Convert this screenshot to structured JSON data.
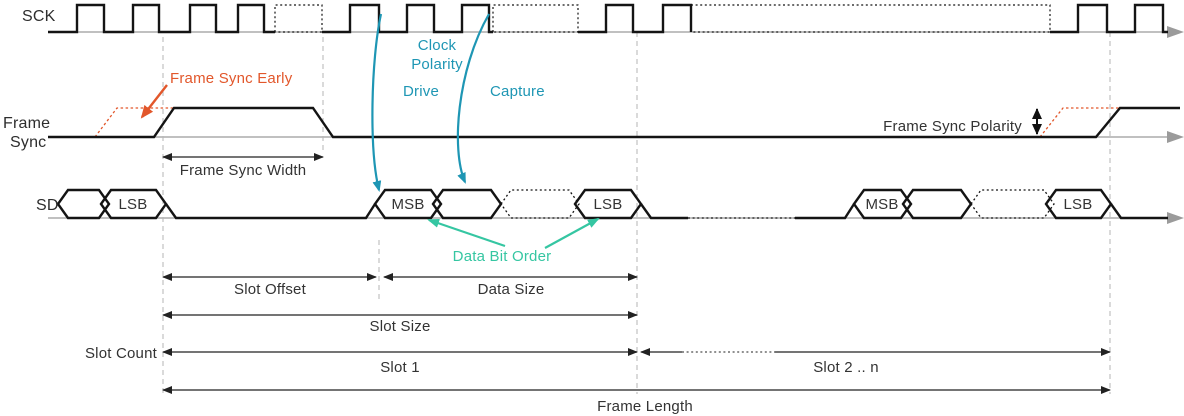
{
  "signals": {
    "sck": "SCK",
    "frame_sync_line1": "Frame",
    "frame_sync_line2": "Sync",
    "sd": "SD"
  },
  "sd_cells": {
    "left_lsb": "LSB",
    "mid_msb": "MSB",
    "mid_lsb": "LSB",
    "right_msb": "MSB",
    "right_lsb": "LSB"
  },
  "annotations": {
    "frame_sync_early": "Frame Sync Early",
    "clock_polarity_line1": "Clock",
    "clock_polarity_line2": "Polarity",
    "drive": "Drive",
    "capture": "Capture",
    "frame_sync_width": "Frame Sync Width",
    "frame_sync_polarity": "Frame Sync Polarity",
    "data_bit_order": "Data Bit Order"
  },
  "dimensions": {
    "slot_offset": "Slot Offset",
    "data_size": "Data Size",
    "slot_size": "Slot Size",
    "slot_count": "Slot Count",
    "slot_1": "Slot 1",
    "slot_2_n": "Slot 2 .. n",
    "frame_length": "Frame Length"
  },
  "colors": {
    "accent_orange": "#e2572b",
    "accent_teal": "#1e96b4",
    "accent_green": "#35c6a2",
    "waveform_black": "#141414",
    "baseline_gray": "#9b9b9b",
    "guide_gray": "#b5b5b5",
    "text": "#333333"
  }
}
